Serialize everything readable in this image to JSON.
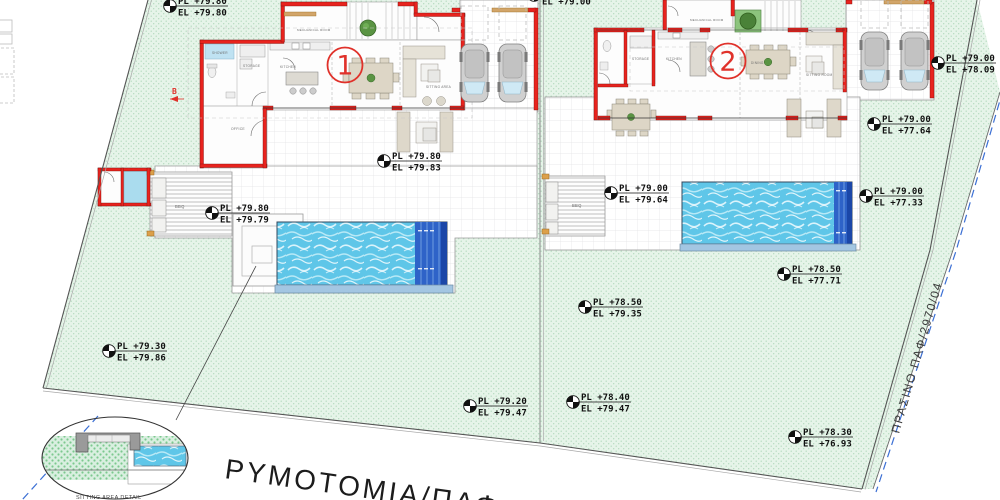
{
  "annotations": {
    "road_label": "ΡΥΜΟΤΟΜΙΑ/ΠΑΦ",
    "green_strip_label": "ΠΡΑΣΙΝΟ ΠΑΦ/2970/04",
    "detail_label": "SITTING AREA DETAIL",
    "section_marker": "B"
  },
  "unit_badges": [
    {
      "x": 345,
      "y": 65,
      "label": "1"
    },
    {
      "x": 728,
      "y": 61,
      "label": "2"
    }
  ],
  "markers": [
    {
      "x": 170,
      "y": 6,
      "pl": "PL +79.80",
      "el": "EL +79.80"
    },
    {
      "x": 534,
      "y": -5,
      "pl": "",
      "el": "EL +79.00"
    },
    {
      "x": 938,
      "y": 63,
      "pl": "PL +79.00",
      "el": "EL +78.09"
    },
    {
      "x": 874,
      "y": 124,
      "pl": "PL +79.00",
      "el": "EL +77.64"
    },
    {
      "x": 384,
      "y": 161,
      "pl": "PL +79.80",
      "el": "EL +79.83"
    },
    {
      "x": 212,
      "y": 213,
      "pl": "PL +79.80",
      "el": "EL +79.79"
    },
    {
      "x": 611,
      "y": 193,
      "pl": "PL +79.00",
      "el": "EL +79.64"
    },
    {
      "x": 866,
      "y": 196,
      "pl": "PL +79.00",
      "el": "EL +77.33"
    },
    {
      "x": 784,
      "y": 274,
      "pl": "PL +78.50",
      "el": "EL +77.71"
    },
    {
      "x": 585,
      "y": 307,
      "pl": "PL +78.50",
      "el": "EL +79.35"
    },
    {
      "x": 109,
      "y": 351,
      "pl": "PL +79.30",
      "el": "EL +79.86"
    },
    {
      "x": 573,
      "y": 402,
      "pl": "PL +78.40",
      "el": "EL +79.47"
    },
    {
      "x": 470,
      "y": 406,
      "pl": "PL +79.20",
      "el": "EL +79.47"
    },
    {
      "x": 795,
      "y": 437,
      "pl": "PL +78.30",
      "el": "EL +76.93"
    }
  ],
  "plan_labels": [
    {
      "x": 212,
      "y": 54,
      "t": "SHOWER",
      "s": 3.2
    },
    {
      "x": 243,
      "y": 67,
      "t": "STORAGE",
      "s": 3.2
    },
    {
      "x": 280,
      "y": 68,
      "t": "KITCHEN",
      "s": 3.2
    },
    {
      "x": 297,
      "y": 31,
      "t": "MECHANICAL ROOM",
      "s": 3.0
    },
    {
      "x": 426,
      "y": 88,
      "t": "SITTING AREA",
      "s": 3.2
    },
    {
      "x": 231,
      "y": 130,
      "t": "OFFICE",
      "s": 3.4
    },
    {
      "x": 175,
      "y": 208,
      "t": "BBQ",
      "s": 4.2
    },
    {
      "x": 690,
      "y": 21,
      "t": "MECHANICAL ROOM",
      "s": 3.0
    },
    {
      "x": 632,
      "y": 60,
      "t": "STORAGE",
      "s": 3.2
    },
    {
      "x": 666,
      "y": 60,
      "t": "KITCHEN",
      "s": 3.2
    },
    {
      "x": 751,
      "y": 64,
      "t": "DINING",
      "s": 3.2
    },
    {
      "x": 806,
      "y": 76,
      "t": "SITTING ROOM",
      "s": 3.2
    },
    {
      "x": 572,
      "y": 207,
      "t": "BBQ",
      "s": 4.2
    }
  ],
  "colors": {
    "wall_red": "#e8231e",
    "water_blue": "#5fc6e8",
    "pool_steps_blue": "#2e63c8",
    "green_area": "#e6f4e9",
    "wood_tan": "#d2a569",
    "badge_red": "#e0312a",
    "boundary_dashed_blue": "#3b6fd4"
  }
}
